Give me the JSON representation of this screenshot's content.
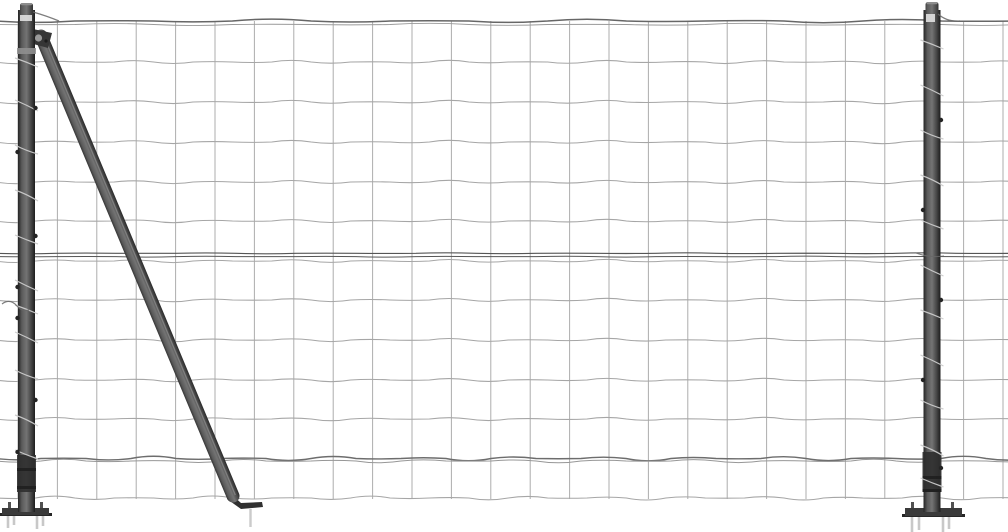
{
  "scene": {
    "subject": "wire-mesh-fence-with-anthracite-flange-posts-and-brace-strut",
    "background_color": "#ffffff",
    "canvas": {
      "width": 1008,
      "height": 532
    },
    "palette": {
      "mesh_wire": "#a6a6a6",
      "mesh_vertical": "#9f9f9f",
      "top_wire": "#676767",
      "top_wire_echo": "#9a9a9a",
      "mid_wire": "#565656",
      "lower_wire_dark": "#6d6d6d",
      "lower_wire_light": "#979797",
      "flange": "#3a3a3a",
      "flange_dark": "#262626",
      "spike": "#c6c6c6",
      "spiral": "#cbcbcb",
      "clamp": "#363636",
      "clamp_hub": "#9a9a9a",
      "post_stops": [
        [
          0,
          "#242424"
        ],
        [
          0.22,
          "#5a5a5a"
        ],
        [
          0.5,
          "#747474"
        ],
        [
          0.78,
          "#454545"
        ],
        [
          1,
          "#1d1d1d"
        ]
      ]
    },
    "mesh": {
      "vertical": {
        "x_start": 18,
        "spacing": 39.4,
        "count": 26,
        "y_top": 21,
        "y_bottom": 499,
        "width": 1,
        "color": "mesh_vertical",
        "opacity": 0.85
      },
      "rows": [
        {
          "y": 21,
          "amp": 1.9,
          "seg": 78.8,
          "color": "top_wire",
          "w": 1.5,
          "phase": 0
        },
        {
          "y": 24.5,
          "amp": 1.2,
          "seg": 78.8,
          "color": "top_wire_echo",
          "w": 0.9,
          "phase": 2
        },
        {
          "y": 62,
          "amp": 1.7,
          "seg": 39.4,
          "color": "mesh_wire",
          "w": 1.05,
          "phase": 0
        },
        {
          "y": 102,
          "amp": 1.7,
          "seg": 39.4,
          "color": "mesh_wire",
          "w": 1.05,
          "phase": 1
        },
        {
          "y": 142,
          "amp": 1.7,
          "seg": 39.4,
          "color": "mesh_wire",
          "w": 1.05,
          "phase": 2
        },
        {
          "y": 182,
          "amp": 1.7,
          "seg": 39.4,
          "color": "mesh_wire",
          "w": 1.05,
          "phase": 3
        },
        {
          "y": 221,
          "amp": 1.7,
          "seg": 39.4,
          "color": "mesh_wire",
          "w": 1.05,
          "phase": 4
        },
        {
          "y": 253.3,
          "amp": 0.5,
          "seg": 60,
          "color": "mid_wire",
          "w": 1.15,
          "phase": 0
        },
        {
          "y": 256.6,
          "amp": 0.5,
          "seg": 60,
          "color": "mid_wire",
          "w": 1.0,
          "phase": 2
        },
        {
          "y": 261,
          "amp": 1.6,
          "seg": 39.4,
          "color": "mesh_wire",
          "w": 1.0,
          "phase": 5
        },
        {
          "y": 300,
          "amp": 1.7,
          "seg": 39.4,
          "color": "mesh_wire",
          "w": 1.05,
          "phase": 6
        },
        {
          "y": 340,
          "amp": 1.7,
          "seg": 39.4,
          "color": "mesh_wire",
          "w": 1.05,
          "phase": 7
        },
        {
          "y": 380,
          "amp": 1.7,
          "seg": 39.4,
          "color": "mesh_wire",
          "w": 1.05,
          "phase": 8
        },
        {
          "y": 419,
          "amp": 1.7,
          "seg": 39.4,
          "color": "mesh_wire",
          "w": 1.05,
          "phase": 9
        },
        {
          "y": 458.5,
          "amp": 2.3,
          "seg": 45,
          "color": "lower_wire_dark",
          "w": 1.45,
          "phase": 0
        },
        {
          "y": 461,
          "amp": 1.8,
          "seg": 45,
          "color": "lower_wire_light",
          "w": 1.0,
          "phase": 3.1
        },
        {
          "y": 498,
          "amp": 2.0,
          "seg": 39.4,
          "color": "mesh_wire",
          "w": 1.05,
          "phase": 10
        }
      ]
    },
    "posts": {
      "left": {
        "x": 18,
        "width": 17,
        "y_top": 10,
        "y_bottom": 512,
        "cap": {
          "x": 20,
          "y": 3,
          "w": 13,
          "h": 9
        },
        "reflect": {
          "x": 20,
          "y": 15,
          "w": 12,
          "h": 6
        },
        "bands": [
          {
            "y": 48,
            "h": 6,
            "color": "#8f8f8f"
          },
          {
            "y": 455,
            "h": 37,
            "color": "#2f2f2f"
          },
          {
            "y": 468,
            "h": 3,
            "color": "#1f1f1f"
          },
          {
            "y": 486,
            "h": 3,
            "color": "#1f1f1f"
          }
        ],
        "spirals": [
          58,
          100,
          145,
          190,
          235,
          280,
          305,
          332,
          370,
          415,
          450
        ],
        "knobs": [
          {
            "side": "r",
            "y": 108
          },
          {
            "side": "l",
            "y": 152
          },
          {
            "side": "r",
            "y": 236
          },
          {
            "side": "l",
            "y": 287
          },
          {
            "side": "l",
            "y": 318
          },
          {
            "side": "r",
            "y": 400
          },
          {
            "side": "l",
            "y": 452
          }
        ],
        "flange": {
          "x": 2,
          "y": 508,
          "w": 47,
          "h": 7
        },
        "pins": [
          {
            "x": 8,
            "y": 502
          },
          {
            "x": 40,
            "y": 502
          }
        ],
        "spikes": [
          {
            "x": 8,
            "len": 13
          },
          {
            "x": 14,
            "len": 10
          },
          {
            "x": 37,
            "len": 14
          },
          {
            "x": 43,
            "len": 11
          }
        ]
      },
      "right": {
        "x": 923.5,
        "width": 17,
        "y_top": 10,
        "y_bottom": 512,
        "cap": {
          "x": 925.5,
          "y": 2,
          "w": 13,
          "h": 10
        },
        "reflect": {
          "x": 926,
          "y": 14,
          "w": 9,
          "h": 8
        },
        "bands": [
          {
            "y": 452,
            "h": 40,
            "color": "#2f2f2f"
          },
          {
            "y": 476,
            "h": 3,
            "color": "#1f1f1f"
          },
          {
            "y": 489,
            "h": 3,
            "color": "#1f1f1f"
          }
        ],
        "spirals": [
          40,
          85,
          130,
          175,
          220,
          265,
          310,
          355,
          400,
          445,
          478
        ],
        "knobs": [
          {
            "side": "r",
            "y": 120
          },
          {
            "side": "l",
            "y": 210
          },
          {
            "side": "r",
            "y": 300
          },
          {
            "side": "l",
            "y": 380
          },
          {
            "side": "r",
            "y": 468
          }
        ],
        "flange": {
          "x": 905,
          "y": 508,
          "w": 57,
          "h": 8
        },
        "pins": [
          {
            "x": 911,
            "y": 502
          },
          {
            "x": 951,
            "y": 502
          }
        ],
        "spikes": [
          {
            "x": 912,
            "len": 17
          },
          {
            "x": 919,
            "len": 14
          },
          {
            "x": 943,
            "len": 18
          },
          {
            "x": 949,
            "len": 13
          }
        ]
      }
    },
    "brace": {
      "x1": 41,
      "y1": 36,
      "x2": 233,
      "y2": 496,
      "width": 13,
      "clamp": {
        "points": "28,28 52,33 48,48 26,42",
        "hub": {
          "cx": 38.5,
          "cy": 38,
          "r": 3.6
        },
        "bolt": {
          "cx": 46,
          "cy": 41,
          "r": 1.6
        }
      },
      "foot": {
        "points": "230,493 241,503 262,502 263,507 241,509 227,499"
      },
      "spike": {
        "x": 250.5,
        "y1": 509,
        "y2": 527
      }
    },
    "wire_accents": [
      {
        "d": "M 33 12 q 14 4 26 9",
        "w": 1.3
      },
      {
        "d": "M 2 304 q 8 -6 15 2 q 5 6 12 4",
        "w": 1.2
      },
      {
        "d": "M 938 14 q 9 8 22 7",
        "w": 1.3
      },
      {
        "d": "M 916 253 q 14 5 28 3",
        "w": 1.1
      }
    ]
  }
}
